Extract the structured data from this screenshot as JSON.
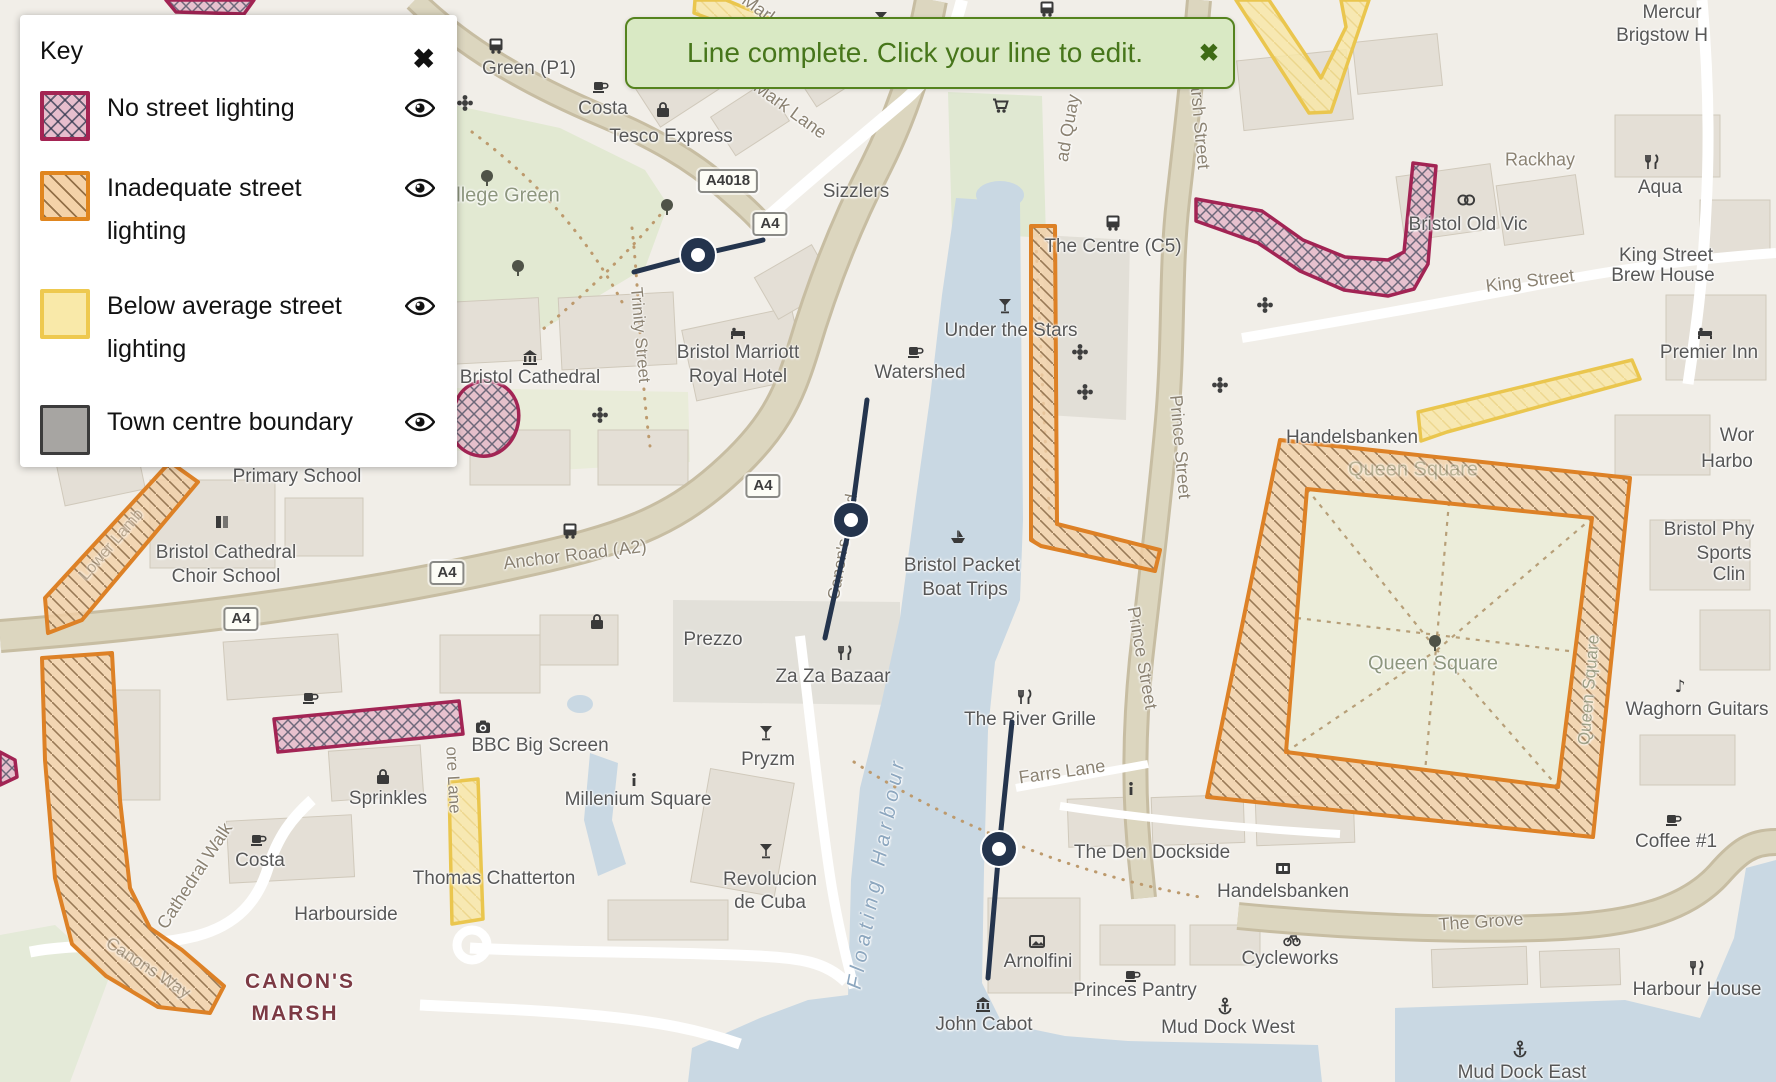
{
  "legend": {
    "title": "Key",
    "close_icon": "✖",
    "items": [
      {
        "label": "No street lighting",
        "type": "no-lighting",
        "fill": "#e7becd",
        "border": "#a42453"
      },
      {
        "label": "Inadequate street lighting",
        "type": "inadequate",
        "fill": "#f4d2a8",
        "border": "#e0861f"
      },
      {
        "label": "Below average street lighting",
        "type": "below-average",
        "fill": "#f9e9a9",
        "border": "#eec94f"
      },
      {
        "label": "Town centre boundary",
        "type": "boundary",
        "fill": "#a7a5a2",
        "border": "#3c3c3c"
      }
    ]
  },
  "toast": {
    "message": "Line complete. Click your line to edit.",
    "close_icon": "✖"
  },
  "colors": {
    "line": "#24344d",
    "toast_bg": "#d9e9c4",
    "toast_text": "#47761b",
    "water": "#c9d8e3"
  },
  "map": {
    "road_badges": [
      {
        "text": "A4018",
        "x": 728,
        "y": 181
      },
      {
        "text": "A4",
        "x": 770,
        "y": 224
      },
      {
        "text": "A4",
        "x": 763,
        "y": 486
      },
      {
        "text": "A4",
        "x": 447,
        "y": 573
      },
      {
        "text": "A4",
        "x": 241,
        "y": 619
      }
    ],
    "labels": [
      {
        "t": "Green (P1)",
        "x": 529,
        "y": 69,
        "s": 19,
        "c": "poi"
      },
      {
        "t": "Costa",
        "x": 603,
        "y": 109,
        "s": 19,
        "c": "poi"
      },
      {
        "t": "Tesco Express",
        "x": 671,
        "y": 137,
        "s": 19,
        "c": "poi"
      },
      {
        "t": "Mark Lane",
        "x": 790,
        "y": 110,
        "s": 18,
        "c": "road",
        "r": 36
      },
      {
        "t": "Mark",
        "x": 760,
        "y": 10,
        "s": 18,
        "c": "road",
        "r": 36
      },
      {
        "t": "llege Green",
        "x": 508,
        "y": 196,
        "s": 20,
        "c": "green"
      },
      {
        "t": "Sizzlers",
        "x": 856,
        "y": 192,
        "s": 19,
        "c": "poi"
      },
      {
        "t": "Under the Stars",
        "x": 1011,
        "y": 331,
        "s": 19,
        "c": "poi"
      },
      {
        "t": "Watershed",
        "x": 920,
        "y": 373,
        "s": 19,
        "c": "poi"
      },
      {
        "t": "The Centre (C5)",
        "x": 1113,
        "y": 247,
        "s": 19,
        "c": "poi"
      },
      {
        "t": "Bristol Marriott",
        "x": 738,
        "y": 353,
        "s": 19,
        "c": "poi"
      },
      {
        "t": "Royal Hotel",
        "x": 738,
        "y": 377,
        "s": 19,
        "c": "poi"
      },
      {
        "t": "Bristol Cathedral",
        "x": 530,
        "y": 378,
        "s": 19,
        "c": "poi"
      },
      {
        "t": "Trinity Street",
        "x": 640,
        "y": 335,
        "s": 17,
        "c": "road",
        "r": 85
      },
      {
        "t": "Primary School",
        "x": 297,
        "y": 477,
        "s": 19,
        "c": "poi"
      },
      {
        "t": "Bristol Cathedral",
        "x": 226,
        "y": 553,
        "s": 19,
        "c": "poi"
      },
      {
        "t": "Choir School",
        "x": 226,
        "y": 577,
        "s": 19,
        "c": "poi"
      },
      {
        "t": "Anchor Road (A2)",
        "x": 575,
        "y": 555,
        "s": 18,
        "c": "road",
        "r": -7
      },
      {
        "t": "Rackhay",
        "x": 1540,
        "y": 160,
        "s": 18,
        "c": "road"
      },
      {
        "t": "Bristol Old Vic",
        "x": 1468,
        "y": 225,
        "s": 19,
        "c": "poi"
      },
      {
        "t": "Aqua",
        "x": 1660,
        "y": 188,
        "s": 19,
        "c": "poi"
      },
      {
        "t": "King Street",
        "x": 1530,
        "y": 281,
        "s": 18,
        "c": "road",
        "r": -7
      },
      {
        "t": "King Street",
        "x": 1666,
        "y": 256,
        "s": 19,
        "c": "poi"
      },
      {
        "t": "Brew House",
        "x": 1663,
        "y": 276,
        "s": 19,
        "c": "poi"
      },
      {
        "t": "Premier Inn",
        "x": 1709,
        "y": 353,
        "s": 19,
        "c": "poi"
      },
      {
        "t": "Mercur",
        "x": 1672,
        "y": 13,
        "s": 19,
        "c": "poi"
      },
      {
        "t": "Brigstow H",
        "x": 1662,
        "y": 36,
        "s": 19,
        "c": "poi"
      },
      {
        "t": "Marsh Street",
        "x": 1199,
        "y": 118,
        "s": 18,
        "c": "road",
        "r": 85
      },
      {
        "t": "ad Quay",
        "x": 1068,
        "y": 128,
        "s": 18,
        "c": "road",
        "r": -80
      },
      {
        "t": "Prince Street",
        "x": 1180,
        "y": 447,
        "s": 18,
        "c": "road",
        "r": 85
      },
      {
        "t": "Prince Street",
        "x": 1142,
        "y": 658,
        "s": 18,
        "c": "road",
        "r": 80
      },
      {
        "t": "Canon's Road",
        "x": 843,
        "y": 547,
        "s": 17,
        "c": "road",
        "r": -80
      },
      {
        "t": "Handelsbanken",
        "x": 1352,
        "y": 438,
        "s": 19,
        "c": "poi"
      },
      {
        "t": "Queen Square",
        "x": 1413,
        "y": 470,
        "s": 20,
        "c": "green",
        "o": 0.55
      },
      {
        "t": "Queen Square",
        "x": 1433,
        "y": 664,
        "s": 20,
        "c": "green"
      },
      {
        "t": "Queen Square",
        "x": 1589,
        "y": 690,
        "s": 17,
        "c": "green",
        "r": -85,
        "o": 0.8
      },
      {
        "t": "Wor",
        "x": 1737,
        "y": 436,
        "s": 19,
        "c": "poi"
      },
      {
        "t": "Harbo",
        "x": 1727,
        "y": 462,
        "s": 19,
        "c": "poi"
      },
      {
        "t": "Bristol Phy",
        "x": 1709,
        "y": 530,
        "s": 19,
        "c": "poi"
      },
      {
        "t": "Sports",
        "x": 1724,
        "y": 554,
        "s": 19,
        "c": "poi"
      },
      {
        "t": "Clin",
        "x": 1729,
        "y": 575,
        "s": 19,
        "c": "poi"
      },
      {
        "t": "Waghorn Guitars",
        "x": 1697,
        "y": 710,
        "s": 19,
        "c": "poi"
      },
      {
        "t": "Coffee #1",
        "x": 1676,
        "y": 842,
        "s": 19,
        "c": "poi"
      },
      {
        "t": "The Grove",
        "x": 1481,
        "y": 922,
        "s": 18,
        "c": "road",
        "r": -4
      },
      {
        "t": "Harbour House",
        "x": 1697,
        "y": 990,
        "s": 19,
        "c": "poi"
      },
      {
        "t": "Mud Dock East",
        "x": 1522,
        "y": 1073,
        "s": 19,
        "c": "poi"
      },
      {
        "t": "Mud Dock West",
        "x": 1228,
        "y": 1028,
        "s": 19,
        "c": "poi"
      },
      {
        "t": "Cycleworks",
        "x": 1290,
        "y": 959,
        "s": 19,
        "c": "poi"
      },
      {
        "t": "Handelsbanken",
        "x": 1283,
        "y": 892,
        "s": 19,
        "c": "poi"
      },
      {
        "t": "The Den Dockside",
        "x": 1152,
        "y": 853,
        "s": 19,
        "c": "poi"
      },
      {
        "t": "Arnolfini",
        "x": 1038,
        "y": 962,
        "s": 19,
        "c": "poi"
      },
      {
        "t": "Princes Pantry",
        "x": 1135,
        "y": 991,
        "s": 19,
        "c": "poi"
      },
      {
        "t": "John Cabot",
        "x": 984,
        "y": 1025,
        "s": 19,
        "c": "poi"
      },
      {
        "t": "The River Grille",
        "x": 1030,
        "y": 720,
        "s": 19,
        "c": "poi"
      },
      {
        "t": "Farrs Lane",
        "x": 1062,
        "y": 772,
        "s": 18,
        "c": "road",
        "r": -8
      },
      {
        "t": "Za Za Bazaar",
        "x": 833,
        "y": 677,
        "s": 19,
        "c": "poi"
      },
      {
        "t": "Prezzo",
        "x": 713,
        "y": 640,
        "s": 19,
        "c": "poi"
      },
      {
        "t": "Pryzm",
        "x": 768,
        "y": 760,
        "s": 19,
        "c": "poi"
      },
      {
        "t": "Millenium Square",
        "x": 638,
        "y": 800,
        "s": 19,
        "c": "poi"
      },
      {
        "t": "BBC Big Screen",
        "x": 540,
        "y": 746,
        "s": 19,
        "c": "poi"
      },
      {
        "t": "Revolucion",
        "x": 770,
        "y": 880,
        "s": 19,
        "c": "poi"
      },
      {
        "t": "de Cuba",
        "x": 770,
        "y": 903,
        "s": 19,
        "c": "poi"
      },
      {
        "t": "Thomas Chatterton",
        "x": 494,
        "y": 879,
        "s": 19,
        "c": "poi"
      },
      {
        "t": "Sprinkles",
        "x": 388,
        "y": 799,
        "s": 19,
        "c": "poi"
      },
      {
        "t": "Costa",
        "x": 260,
        "y": 861,
        "s": 19,
        "c": "poi"
      },
      {
        "t": "Harbourside",
        "x": 346,
        "y": 915,
        "s": 19,
        "c": "poi"
      },
      {
        "t": "CANON'S",
        "x": 300,
        "y": 982,
        "s": 21,
        "c": "marsh",
        "w": 700,
        "ls": 2
      },
      {
        "t": "MARSH",
        "x": 295,
        "y": 1014,
        "s": 21,
        "c": "marsh",
        "w": 700,
        "ls": 2
      },
      {
        "t": "Cathedral Walk",
        "x": 195,
        "y": 876,
        "s": 18,
        "c": "road",
        "r": -57
      },
      {
        "t": "Canons Way",
        "x": 148,
        "y": 968,
        "s": 17,
        "c": "road",
        "r": 33,
        "o": 0.65
      },
      {
        "t": "ore Lane",
        "x": 453,
        "y": 780,
        "s": 17,
        "c": "road",
        "r": 87
      },
      {
        "t": "Lower Lamb",
        "x": 112,
        "y": 545,
        "s": 16,
        "c": "road",
        "r": -49,
        "o": 0.55
      },
      {
        "t": "Floating Harbour",
        "x": 877,
        "y": 873,
        "s": 21,
        "c": "water",
        "r": -79,
        "i": 1,
        "ls": 5
      },
      {
        "t": "Bristol Packet",
        "x": 962,
        "y": 566,
        "s": 19,
        "c": "poi"
      },
      {
        "t": "Boat Trips",
        "x": 965,
        "y": 590,
        "s": 19,
        "c": "poi"
      }
    ],
    "icons": [
      {
        "n": "tree",
        "x": 487,
        "y": 178
      },
      {
        "n": "tree",
        "x": 667,
        "y": 207
      },
      {
        "n": "tree",
        "x": 518,
        "y": 268
      },
      {
        "n": "tree",
        "x": 1435,
        "y": 643
      },
      {
        "n": "bus",
        "x": 496,
        "y": 45
      },
      {
        "n": "bus",
        "x": 1047,
        "y": 8
      },
      {
        "n": "bus",
        "x": 1113,
        "y": 222
      },
      {
        "n": "bus",
        "x": 570,
        "y": 530
      },
      {
        "n": "coffee",
        "x": 600,
        "y": 85
      },
      {
        "n": "coffee",
        "x": 915,
        "y": 350
      },
      {
        "n": "coffee",
        "x": 310,
        "y": 696
      },
      {
        "n": "coffee",
        "x": 258,
        "y": 838
      },
      {
        "n": "coffee",
        "x": 1132,
        "y": 974
      },
      {
        "n": "coffee",
        "x": 1673,
        "y": 818
      },
      {
        "n": "bag",
        "x": 663,
        "y": 110
      },
      {
        "n": "bag",
        "x": 383,
        "y": 777
      },
      {
        "n": "bag",
        "x": 597,
        "y": 622
      },
      {
        "n": "fork",
        "x": 1652,
        "y": 162
      },
      {
        "n": "fork",
        "x": 845,
        "y": 653
      },
      {
        "n": "fork",
        "x": 1025,
        "y": 697
      },
      {
        "n": "fork",
        "x": 1697,
        "y": 968
      },
      {
        "n": "cocktail",
        "x": 1005,
        "y": 305
      },
      {
        "n": "cocktail",
        "x": 766,
        "y": 732
      },
      {
        "n": "cocktail",
        "x": 766,
        "y": 850
      },
      {
        "n": "cocktail",
        "x": 881,
        "y": 18
      },
      {
        "n": "bed",
        "x": 738,
        "y": 332
      },
      {
        "n": "bed",
        "x": 1705,
        "y": 332
      },
      {
        "n": "camera",
        "x": 483,
        "y": 727
      },
      {
        "n": "museum",
        "x": 530,
        "y": 357
      },
      {
        "n": "museum",
        "x": 983,
        "y": 1004
      },
      {
        "n": "pic",
        "x": 1037,
        "y": 941
      },
      {
        "n": "bank",
        "x": 1283,
        "y": 868
      },
      {
        "n": "anchor",
        "x": 1225,
        "y": 1006
      },
      {
        "n": "anchor",
        "x": 1520,
        "y": 1049
      },
      {
        "n": "info",
        "x": 634,
        "y": 780
      },
      {
        "n": "info",
        "x": 1131,
        "y": 789
      },
      {
        "n": "bike",
        "x": 1292,
        "y": 938
      },
      {
        "n": "note",
        "x": 1680,
        "y": 686
      },
      {
        "n": "flower",
        "x": 465,
        "y": 103
      },
      {
        "n": "flower",
        "x": 600,
        "y": 415
      },
      {
        "n": "flower",
        "x": 1080,
        "y": 352
      },
      {
        "n": "flower",
        "x": 1085,
        "y": 392
      },
      {
        "n": "flower",
        "x": 1265,
        "y": 305
      },
      {
        "n": "flower",
        "x": 1220,
        "y": 385
      },
      {
        "n": "boat",
        "x": 958,
        "y": 536
      },
      {
        "n": "cart",
        "x": 1000,
        "y": 105
      },
      {
        "n": "theater",
        "x": 1466,
        "y": 200
      },
      {
        "n": "school",
        "x": 222,
        "y": 522
      }
    ],
    "lines": [
      {
        "points": [
          [
            634,
            272
          ],
          [
            698,
            255
          ],
          [
            763,
            240
          ]
        ],
        "vertex": [
          698,
          255
        ]
      },
      {
        "points": [
          [
            867,
            400
          ],
          [
            851,
            520
          ],
          [
            825,
            638
          ]
        ],
        "vertex": [
          851,
          520
        ]
      },
      {
        "points": [
          [
            1012,
            722
          ],
          [
            999,
            849
          ],
          [
            988,
            978
          ]
        ],
        "vertex": [
          999,
          849
        ]
      }
    ],
    "overlays": [
      {
        "type": "no",
        "path": "M1196,199 L1262,211 L1303,240 L1345,257 L1388,260 L1404,252 L1413,163 L1436,166 L1428,264 L1414,289 L1388,296 L1344,290 L1300,271 L1258,243 L1196,221 Z"
      },
      {
        "type": "no",
        "path": "M456,402 C462,386 478,378 494,382 C510,386 522,402 518,424 C514,444 498,458 480,456 C462,454 450,440 450,424 C450,416 452,408 456,402 Z"
      },
      {
        "type": "no",
        "path": "M274,719 L459,701 L463,734 L278,752 Z"
      },
      {
        "type": "no",
        "path": "M0,752 L15,760 L17,777 L0,785 Z"
      },
      {
        "type": "no",
        "path": "M166,0 L254,0 L244,14 L176,12 Z"
      },
      {
        "type": "inadequate",
        "path": "M45,598 L170,462 L198,482 L82,620 L48,633 Z"
      },
      {
        "type": "inadequate",
        "path": "M42,658 L112,653 L120,800 L130,888 L150,928 L182,950 L224,986 L210,1013 L158,1007 L106,976 L72,944 L55,878 L45,760 Z"
      },
      {
        "type": "inadequate",
        "path": "M1031,226 L1055,226 L1057,524 L1160,550 L1155,571 L1041,546 L1031,540 Z"
      },
      {
        "type": "inadequate",
        "path": "M1280,440 L1630,478 L1593,837 L1207,797 Z M1307,489 L1592,518 L1558,787 L1286,752 Z"
      },
      {
        "type": "below",
        "path": "M695,0 L726,0 L815,37 L807,55 L694,13 Z"
      },
      {
        "type": "below",
        "path": "M1236,0 L1269,0 L1321,78 L1346,27 L1341,0 L1369,0 L1331,112 L1309,113 Z"
      },
      {
        "type": "below",
        "path": "M1418,412 L1632,360 L1640,379 L1447,432 L1421,441 Z"
      },
      {
        "type": "below",
        "path": "M449,782 L478,779 L483,919 L452,924 Z"
      }
    ]
  }
}
